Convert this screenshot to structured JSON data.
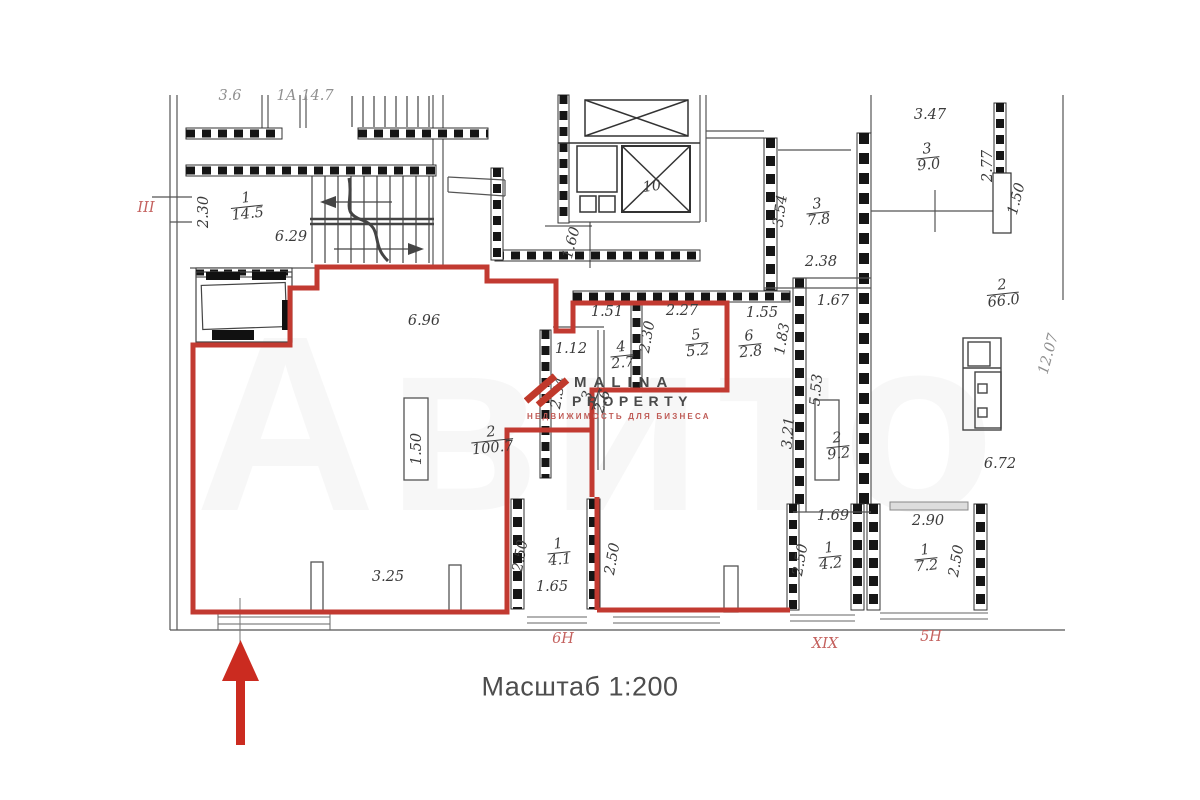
{
  "colors": {
    "unit_outline": "#c23a31",
    "wall": "#1a1a1a",
    "dim_text": "#3b3b3b",
    "zone_label": "#c4615e",
    "scale_text": "#4d4d4d",
    "arrow": "#cb2b20",
    "brand_red": "#c0392b",
    "brand_gray": "#4a4a4a"
  },
  "plan": {
    "scale_label": "Масштаб 1:200",
    "elevator_label": "10",
    "zone_labels": {
      "left": "III",
      "loggia": "6Н",
      "corridor": "XIX",
      "right": "5Н"
    },
    "partial_top": {
      "a": "3.6",
      "b": "1А  14.7"
    },
    "dims": {
      "d230": "2.30",
      "d629": "6.29",
      "d160": "1.60",
      "d347": "3.47",
      "d277": "2.77",
      "d150": "1.50",
      "d354": "3.54",
      "d238": "2.38",
      "d167": "1.67",
      "d151": "1.51",
      "d227": "2.27",
      "d155": "1.55",
      "d112": "1.12",
      "d183": "1.83",
      "d234": "2.34",
      "d696": "6.96",
      "d553": "5.53",
      "d321": "3.21",
      "d1207": "12.07",
      "d672": "6.72",
      "d325": "3.25",
      "d250": "2.50",
      "d165": "1.65",
      "d169": "1.69",
      "d290": "2.90"
    },
    "rooms": {
      "stair": {
        "num": "1",
        "area": "14.5"
      },
      "main": {
        "num": "2",
        "area": "100.7"
      },
      "r3": {
        "num": "3",
        "area": "2.6"
      },
      "r4": {
        "num": "4",
        "area": "2.7"
      },
      "r5": {
        "num": "5",
        "area": "5.2"
      },
      "r6": {
        "num": "6",
        "area": "2.8"
      },
      "r78": {
        "num": "3",
        "area": "7.8"
      },
      "r90": {
        "num": "3",
        "area": "9.0"
      },
      "r66": {
        "num": "2",
        "area": "66.0"
      },
      "r92": {
        "num": "2",
        "area": "9.2"
      },
      "loggia": {
        "num": "1",
        "area": "4.1"
      },
      "r42": {
        "num": "1",
        "area": "4.2"
      },
      "r72": {
        "num": "1",
        "area": "7.2"
      }
    }
  },
  "watermark": {
    "brand_top": "MALINA",
    "brand_bottom": "PROPERTY",
    "tagline": "НЕДВИЖИМОСТЬ ДЛЯ БИЗНЕСА",
    "ghost": "Авито"
  }
}
